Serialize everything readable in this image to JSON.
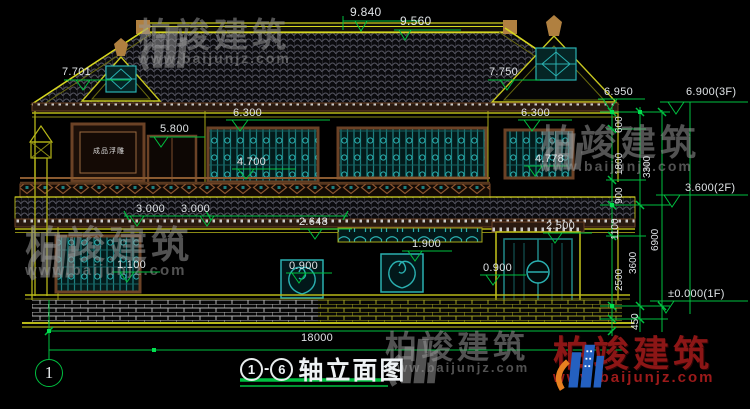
{
  "drawing": {
    "title": {
      "start_axis": "1",
      "end_axis": "6",
      "dash": "-",
      "label": "轴立面图"
    },
    "axis_bubble": "1",
    "panel_text": "成品浮雕"
  },
  "marks": {
    "m9840": "9.840",
    "m9560": "9.560",
    "m7701": "7.701",
    "m7750": "7.750",
    "m6950": "6.950",
    "m6900": "6.900(3F)",
    "m6300l": "6.300",
    "m6300r": "6.300",
    "m5800": "5.800",
    "m4700": "4.700",
    "m4778": "4.778",
    "m3600": "3.600(2F)",
    "m3000a": "3.000",
    "m3000b": "3.000",
    "m2648": "2.648",
    "m1900": "1.900",
    "m2500": "2.500",
    "m1100": "1.100",
    "m0900a": "0.900",
    "m0900b": "0.900",
    "m0000": "±0.000(1F)",
    "m18000": "18000"
  },
  "chain": {
    "c600": "600",
    "c1800": "1800",
    "c900": "900",
    "c1100": "1100",
    "c2500": "2500",
    "c450": "450",
    "c3300": "3300",
    "c3600": "3600",
    "c6900": "6900"
  },
  "watermark": {
    "brand": "柏竣建筑",
    "url": "www.baijunjz.com"
  },
  "colors": {
    "background": "#000000",
    "dimension_green": "#00c040",
    "line_yellow": "#a8a818",
    "accent_yellow": "#d6d620",
    "teal": "#1d8080",
    "teal_bright": "#2ab0b0",
    "frame_brown": "#6b4226",
    "text": "#dfe3e6",
    "watermark_gray": "#969696",
    "watermark_red": "#8c1616",
    "logo_blue": "#2460c0",
    "logo_orange": "#e88020",
    "finial_tan": "#b08040"
  }
}
